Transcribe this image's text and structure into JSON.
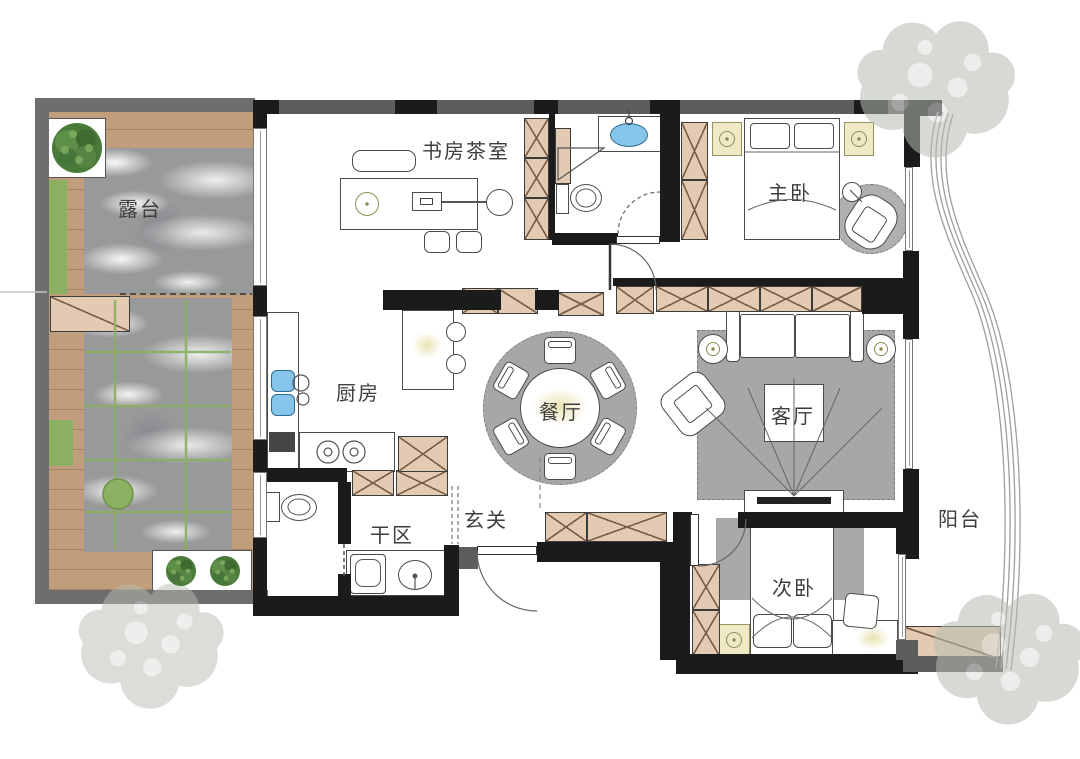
{
  "canvas": {
    "width": 1080,
    "height": 759
  },
  "rooms": {
    "terrace": {
      "label": "露台"
    },
    "study_tea": {
      "label": "书房茶室"
    },
    "master_bedroom": {
      "label": "主卧"
    },
    "kitchen": {
      "label": "厨房"
    },
    "dining": {
      "label": "餐厅"
    },
    "living": {
      "label": "客厅"
    },
    "dry_area": {
      "label": "干区"
    },
    "foyer": {
      "label": "玄关"
    },
    "second_bedroom": {
      "label": "次卧"
    },
    "balcony": {
      "label": "阳台"
    }
  },
  "colors": {
    "wall": "#1b1b1b",
    "wall_gray": "#5d5d5d",
    "terrace_wall": "#6e6e6e",
    "wood": "#c09e7b",
    "cabinet": "#e2cbb2",
    "hatch": "#7a5c46",
    "green": "#8cb061",
    "tree_green": "#4a7a39",
    "faded_tree": "#b7bdb2",
    "marble": "#98999b",
    "rug": "#a7a7a7",
    "water": "#86c5ea",
    "accent": "#efeac6"
  }
}
